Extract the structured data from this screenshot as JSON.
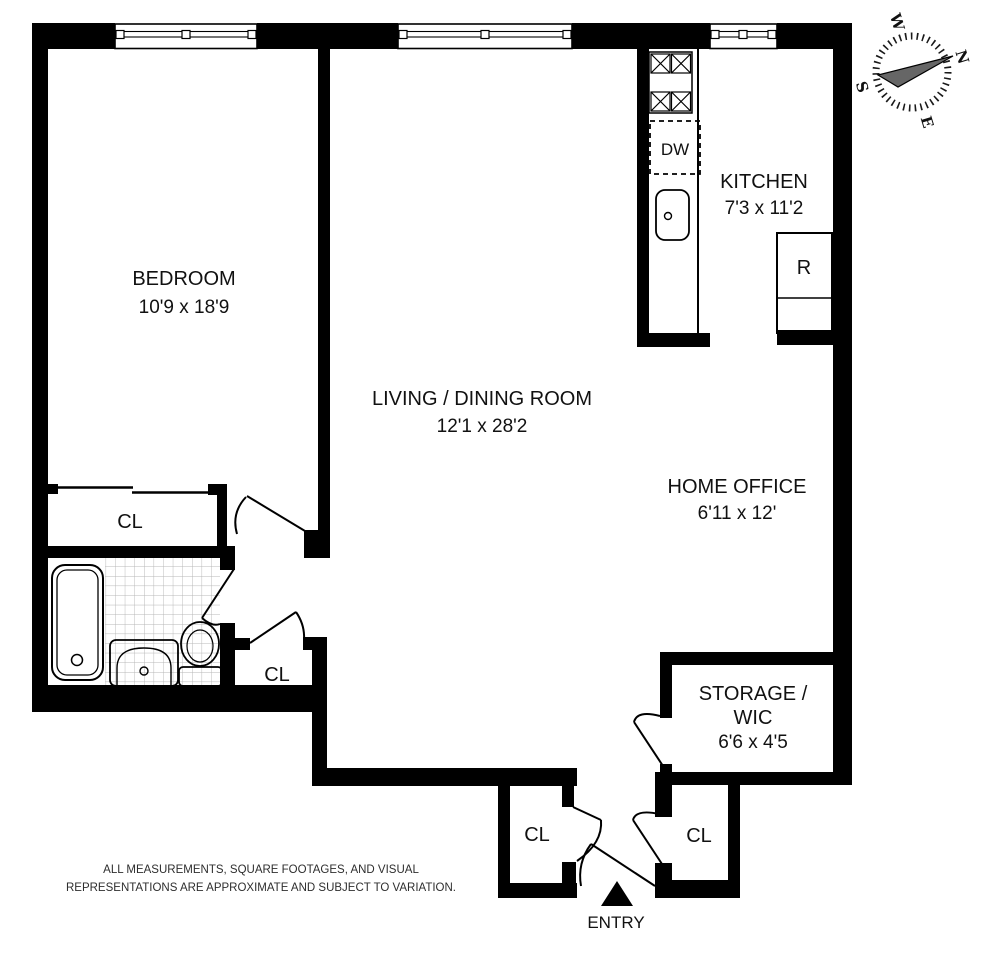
{
  "floorplan": {
    "rooms": [
      {
        "name": "BEDROOM",
        "dims": "10'9 x 18'9"
      },
      {
        "name": "LIVING / DINING ROOM",
        "dims": "12'1 x 28'2"
      },
      {
        "name": "KITCHEN",
        "dims": "7'3 x 11'2"
      },
      {
        "name": "HOME OFFICE",
        "dims": "6'11 x 12'"
      },
      {
        "name": "STORAGE /",
        "name_line2": "WIC",
        "dims": "6'6 x 4'5"
      }
    ],
    "closets": {
      "bedroom_closet": "CL",
      "hall_closet": "CL",
      "foyer_closet_left": "CL",
      "foyer_closet_right": "CL"
    },
    "appliances": {
      "dishwasher": "DW",
      "refrigerator": "R"
    },
    "entry_label": "ENTRY",
    "compass": {
      "n": "N",
      "e": "E",
      "s": "S",
      "w": "W"
    },
    "disclaimer": {
      "line1": "ALL MEASUREMENTS, SQUARE FOOTAGES, AND VISUAL",
      "line2": "REPRESENTATIONS ARE APPROXIMATE AND SUBJECT TO VARIATION."
    },
    "colors": {
      "wall": "#000000",
      "background": "#ffffff",
      "text": "#111111",
      "tile_line": "#b5b5b5"
    }
  }
}
